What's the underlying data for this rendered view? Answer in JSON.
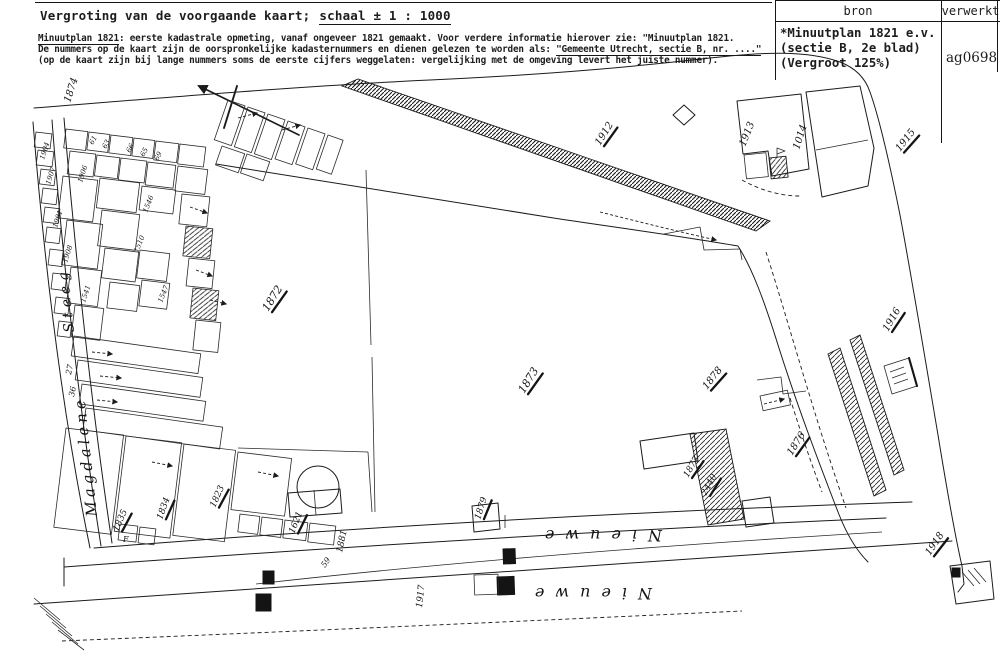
{
  "header": {
    "title_lead": "Vergroting van de voorgaande kaart;",
    "title_scale": "schaal ± 1 : 1000",
    "note1_underlined": "Minuutplan 1821",
    "note1_rest": ": eerste kadastrale opmeting, vanaf ongeveer 1821 gemaakt. Voor verdere informatie hierover zie: \"Minuutplan 1821.",
    "note2_lead": "De nummers op de kaart zijn de oorspronkelijke kadasternummers en dienen gelezen te worden als: ",
    "note2_underlined": "\"Gemeente Utrecht, sectie B, nr. ....\"",
    "note3": "(op de kaart zijn bij lange nummers soms de eerste cijfers weggelaten: vergelijking met de omgeving levert het juiste nummer)."
  },
  "source_table": {
    "col_bron": "bron",
    "col_verwerkt": "verwerkt",
    "bron_line1": "*Minuutplan 1821 e.v.",
    "bron_line2": "(sectie B, 2e blad)",
    "bron_line3": "(Vergroot 125%)",
    "verwerkt_code": "ag0698"
  },
  "map": {
    "labels": [
      {
        "t": "Magdalene",
        "x": 97,
        "y": 516,
        "r": -96,
        "s": 15,
        "k": "street",
        "ls": 4
      },
      {
        "t": "Steeg",
        "x": 74,
        "y": 332,
        "r": -96,
        "s": 14,
        "k": "street",
        "ls": 5
      },
      {
        "t": "Nieuwe",
        "x": 662,
        "y": 530,
        "r": 180,
        "s": 16,
        "k": "street",
        "ls": 11
      },
      {
        "t": "Nieuwe",
        "x": 652,
        "y": 588,
        "r": 180,
        "s": 16,
        "k": "street",
        "ls": 11
      },
      {
        "t": "1874",
        "x": 70,
        "y": 103,
        "r": -72,
        "s": 10
      },
      {
        "t": "1872",
        "x": 268,
        "y": 312,
        "r": -58,
        "s": 11,
        "u": 1
      },
      {
        "t": "1873",
        "x": 524,
        "y": 394,
        "r": -58,
        "s": 11,
        "u": 1
      },
      {
        "t": "1912",
        "x": 600,
        "y": 146,
        "r": -58,
        "s": 10,
        "u": 1
      },
      {
        "t": "1913",
        "x": 745,
        "y": 147,
        "r": -68,
        "s": 10
      },
      {
        "t": "1014",
        "x": 799,
        "y": 150,
        "r": -72,
        "s": 10
      },
      {
        "t": "1915",
        "x": 900,
        "y": 152,
        "r": -52,
        "s": 10,
        "u": 1
      },
      {
        "t": "1916",
        "x": 888,
        "y": 332,
        "r": -60,
        "s": 10,
        "u": 1
      },
      {
        "t": "1878",
        "x": 707,
        "y": 390,
        "r": -52,
        "s": 10,
        "u": 1
      },
      {
        "t": "1876",
        "x": 792,
        "y": 456,
        "r": -58,
        "s": 10,
        "u": 1
      },
      {
        "t": "1877",
        "x": 688,
        "y": 478,
        "r": -60,
        "s": 9,
        "u": 1
      },
      {
        "t": "2440",
        "x": 706,
        "y": 496,
        "r": -62,
        "s": 9,
        "u": 1
      },
      {
        "t": "1918",
        "x": 930,
        "y": 556,
        "r": -56,
        "s": 10,
        "u": 1
      },
      {
        "t": "1879",
        "x": 480,
        "y": 520,
        "r": -72,
        "s": 9,
        "u": 1
      },
      {
        "t": "1917",
        "x": 422,
        "y": 608,
        "r": -84,
        "s": 9
      },
      {
        "t": "1881",
        "x": 342,
        "y": 553,
        "r": -78,
        "s": 9
      },
      {
        "t": "59",
        "x": 325,
        "y": 568,
        "r": -55,
        "s": 8
      },
      {
        "t": "1835",
        "x": 118,
        "y": 532,
        "r": -66,
        "s": 9,
        "u": 1
      },
      {
        "t": "1834",
        "x": 162,
        "y": 520,
        "r": -70,
        "s": 9,
        "u": 1
      },
      {
        "t": "1823",
        "x": 215,
        "y": 508,
        "r": -66,
        "s": 9,
        "u": 1
      },
      {
        "t": "1621",
        "x": 294,
        "y": 534,
        "r": -68,
        "s": 9,
        "u": 1
      },
      {
        "t": "27",
        "x": 71,
        "y": 375,
        "r": -78,
        "s": 8
      },
      {
        "t": "36",
        "x": 74,
        "y": 397,
        "r": -78,
        "s": 8
      },
      {
        "t": "F",
        "x": 123,
        "y": 542,
        "r": 0,
        "s": 8
      },
      {
        "t": "61",
        "x": 93,
        "y": 145,
        "r": -62,
        "s": 7
      },
      {
        "t": "63",
        "x": 106,
        "y": 149,
        "r": -62,
        "s": 7
      },
      {
        "t": "66",
        "x": 130,
        "y": 153,
        "r": -62,
        "s": 7
      },
      {
        "t": "65",
        "x": 144,
        "y": 157,
        "r": -62,
        "s": 7
      },
      {
        "t": "69",
        "x": 158,
        "y": 161,
        "r": -62,
        "s": 7
      },
      {
        "t": "1904",
        "x": 44,
        "y": 160,
        "r": -72,
        "s": 7
      },
      {
        "t": "1907",
        "x": 50,
        "y": 185,
        "r": -72,
        "s": 7
      },
      {
        "t": "1906",
        "x": 82,
        "y": 183,
        "r": -72,
        "s": 7
      },
      {
        "t": "1901",
        "x": 57,
        "y": 228,
        "r": -72,
        "s": 7
      },
      {
        "t": "1908",
        "x": 67,
        "y": 263,
        "r": -72,
        "s": 7
      },
      {
        "t": "1541",
        "x": 85,
        "y": 303,
        "r": -72,
        "s": 7
      },
      {
        "t": "1546",
        "x": 147,
        "y": 213,
        "r": -68,
        "s": 7
      },
      {
        "t": "1510",
        "x": 138,
        "y": 253,
        "r": -68,
        "s": 7
      },
      {
        "t": "1547",
        "x": 162,
        "y": 303,
        "r": -68,
        "s": 7
      }
    ]
  }
}
